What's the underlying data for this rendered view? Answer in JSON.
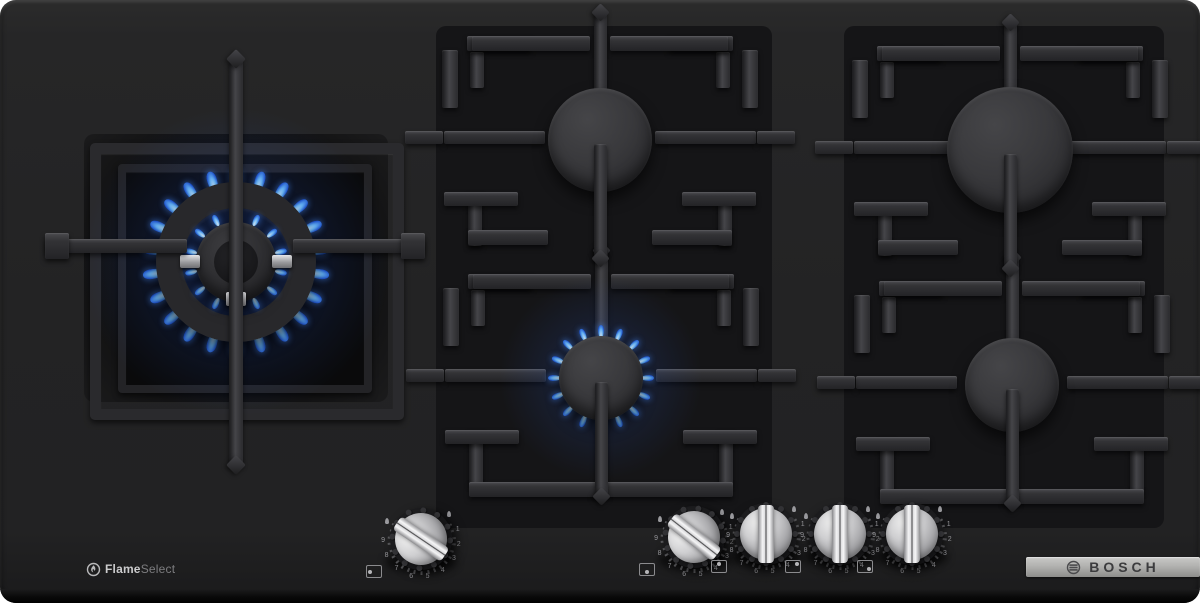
{
  "brand_badge": {
    "brand": "BOSCH"
  },
  "feature_badge": {
    "bold": "Flame",
    "light": "Select"
  },
  "burners": [
    {
      "id": "wok-left",
      "state": "lit",
      "rings": 2
    },
    {
      "id": "back-center",
      "state": "off",
      "rings": 1
    },
    {
      "id": "front-center",
      "state": "lit",
      "rings": 1
    },
    {
      "id": "back-right",
      "state": "off",
      "rings": 1
    },
    {
      "id": "front-right",
      "state": "off",
      "rings": 1
    }
  ],
  "knobs": [
    {
      "id": "knob-wok",
      "rotation_deg": -56,
      "dot": "left"
    },
    {
      "id": "knob-front-center",
      "rotation_deg": -52,
      "dot": "bottom"
    },
    {
      "id": "knob-back-center",
      "rotation_deg": 0,
      "dot": "top"
    },
    {
      "id": "knob-back-right",
      "rotation_deg": 0,
      "dot": "top-right"
    },
    {
      "id": "knob-front-right",
      "rotation_deg": 0,
      "dot": "bottom-right"
    }
  ],
  "dial": {
    "numbers": [
      "1",
      "2",
      "3",
      "4",
      "5",
      "6",
      "7",
      "8",
      "9"
    ]
  },
  "colors": {
    "flame_core": "#d8efff",
    "flame_mid": "#62aef2",
    "flame_deep": "#1d50c8",
    "badge_silver": "#b9b9b7",
    "surface": "#232325"
  }
}
